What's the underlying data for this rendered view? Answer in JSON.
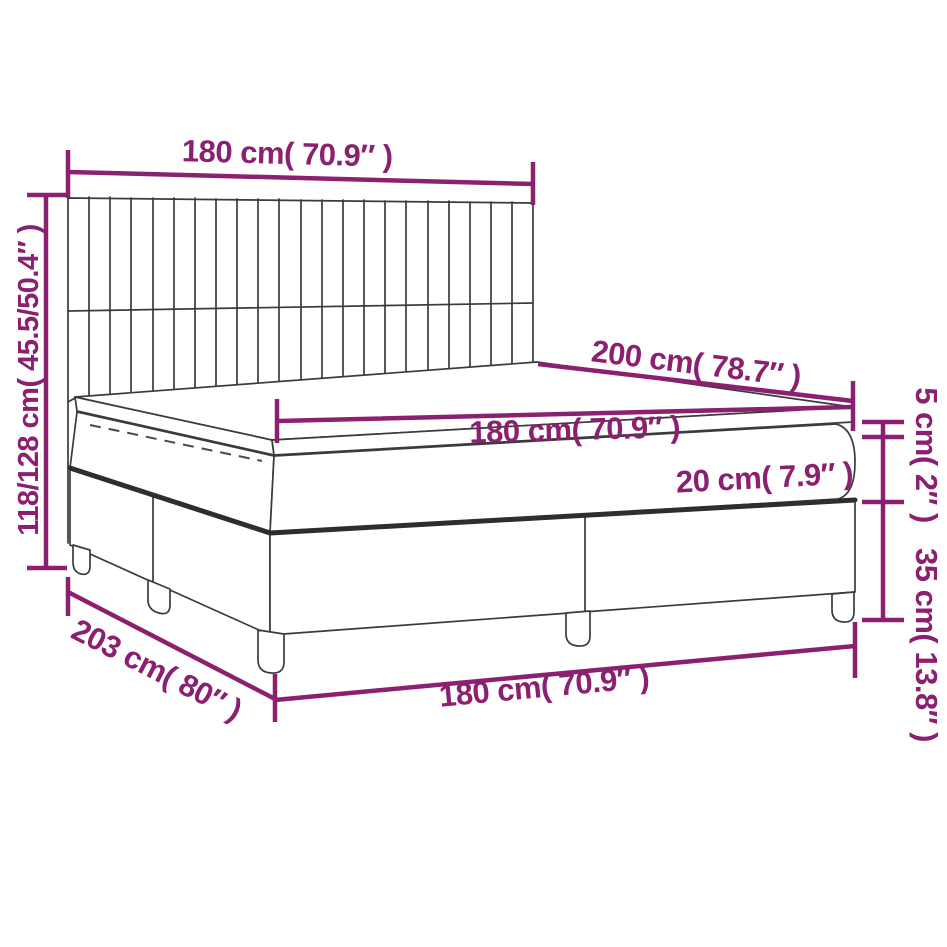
{
  "diagram": {
    "colors": {
      "accent": "#8c2070",
      "line_art": "#3b3b3b",
      "background": "#ffffff"
    },
    "dimensions": {
      "headboard_width": "180 cm( 70.9″ )",
      "overall_height": "118/128 cm( 45.5/50.4″ )",
      "bed_length": "200 cm( 78.7″ )",
      "mattress_width": "180 cm( 70.9″ )",
      "mattress_thickness": "20 cm( 7.9″ )",
      "topper_thickness": "5 cm( 2″ )",
      "base_height": "35 cm( 13.8″ )",
      "base_side_length": "203 cm( 80″ )",
      "base_width": "180 cm( 70.9″ )"
    }
  }
}
